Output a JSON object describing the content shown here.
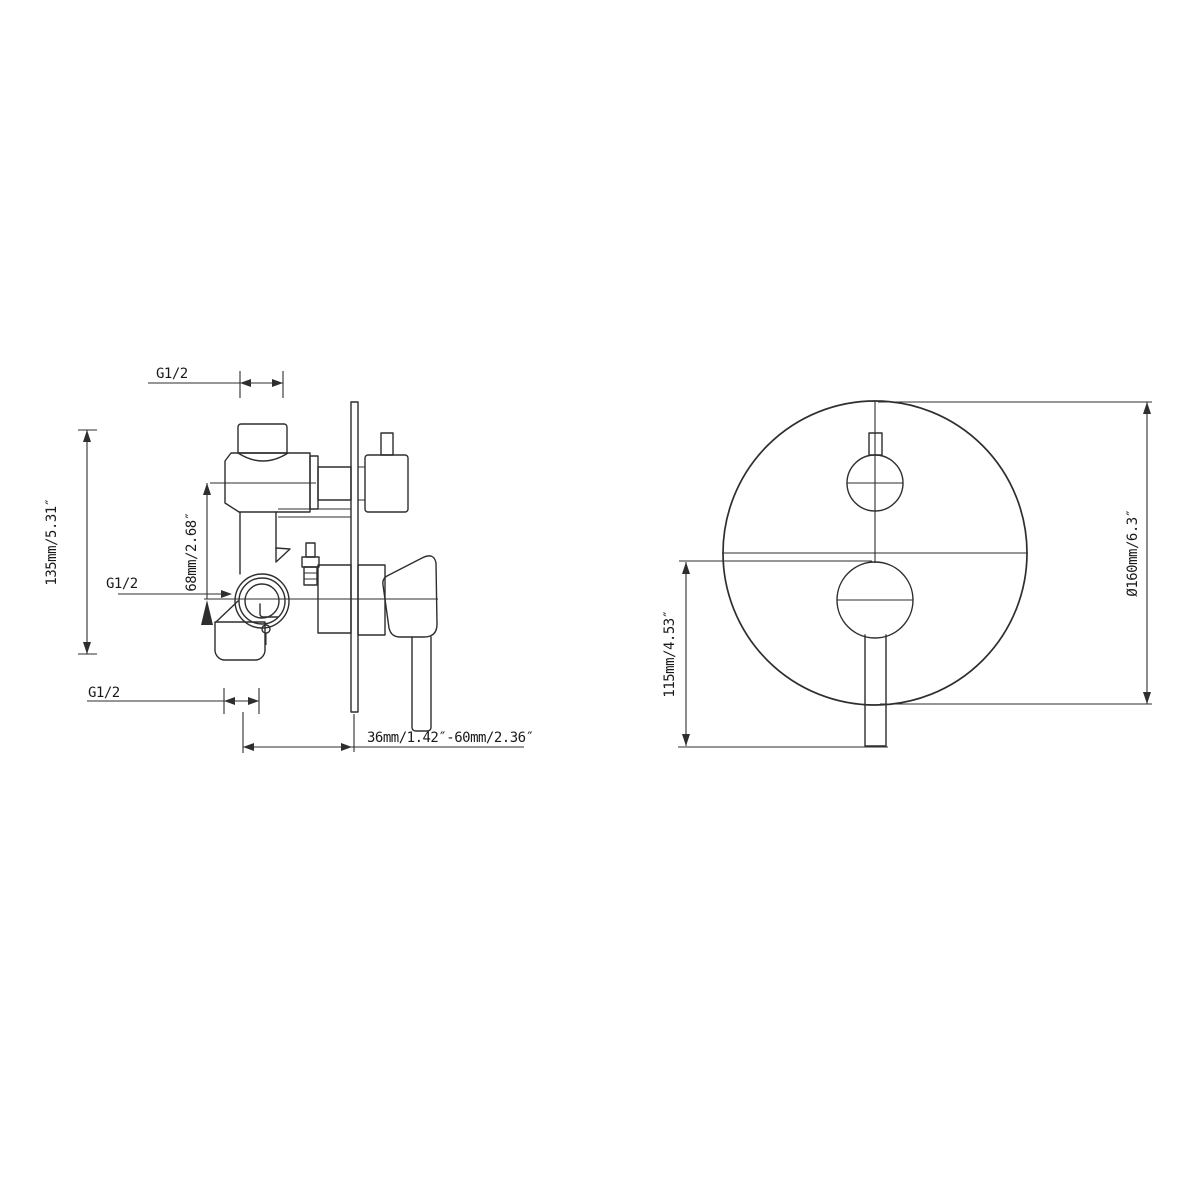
{
  "drawing": {
    "ink_color": "#2e2e2e",
    "background_color": "#ffffff",
    "side_view": {
      "thread_label_top": "G1/2",
      "thread_label_mid": "G1/2",
      "thread_label_bottom": "G1/2",
      "dim_overall_height": "135mm/5.31″",
      "dim_inlet_to_outlet": "68mm/2.68″",
      "dim_install_depth_range": "36mm/1.42″-60mm/2.36″"
    },
    "front_view": {
      "dim_handle_drop": "115mm/4.53″",
      "dim_plate_diameter": "Ø160mm/6.3″"
    }
  }
}
